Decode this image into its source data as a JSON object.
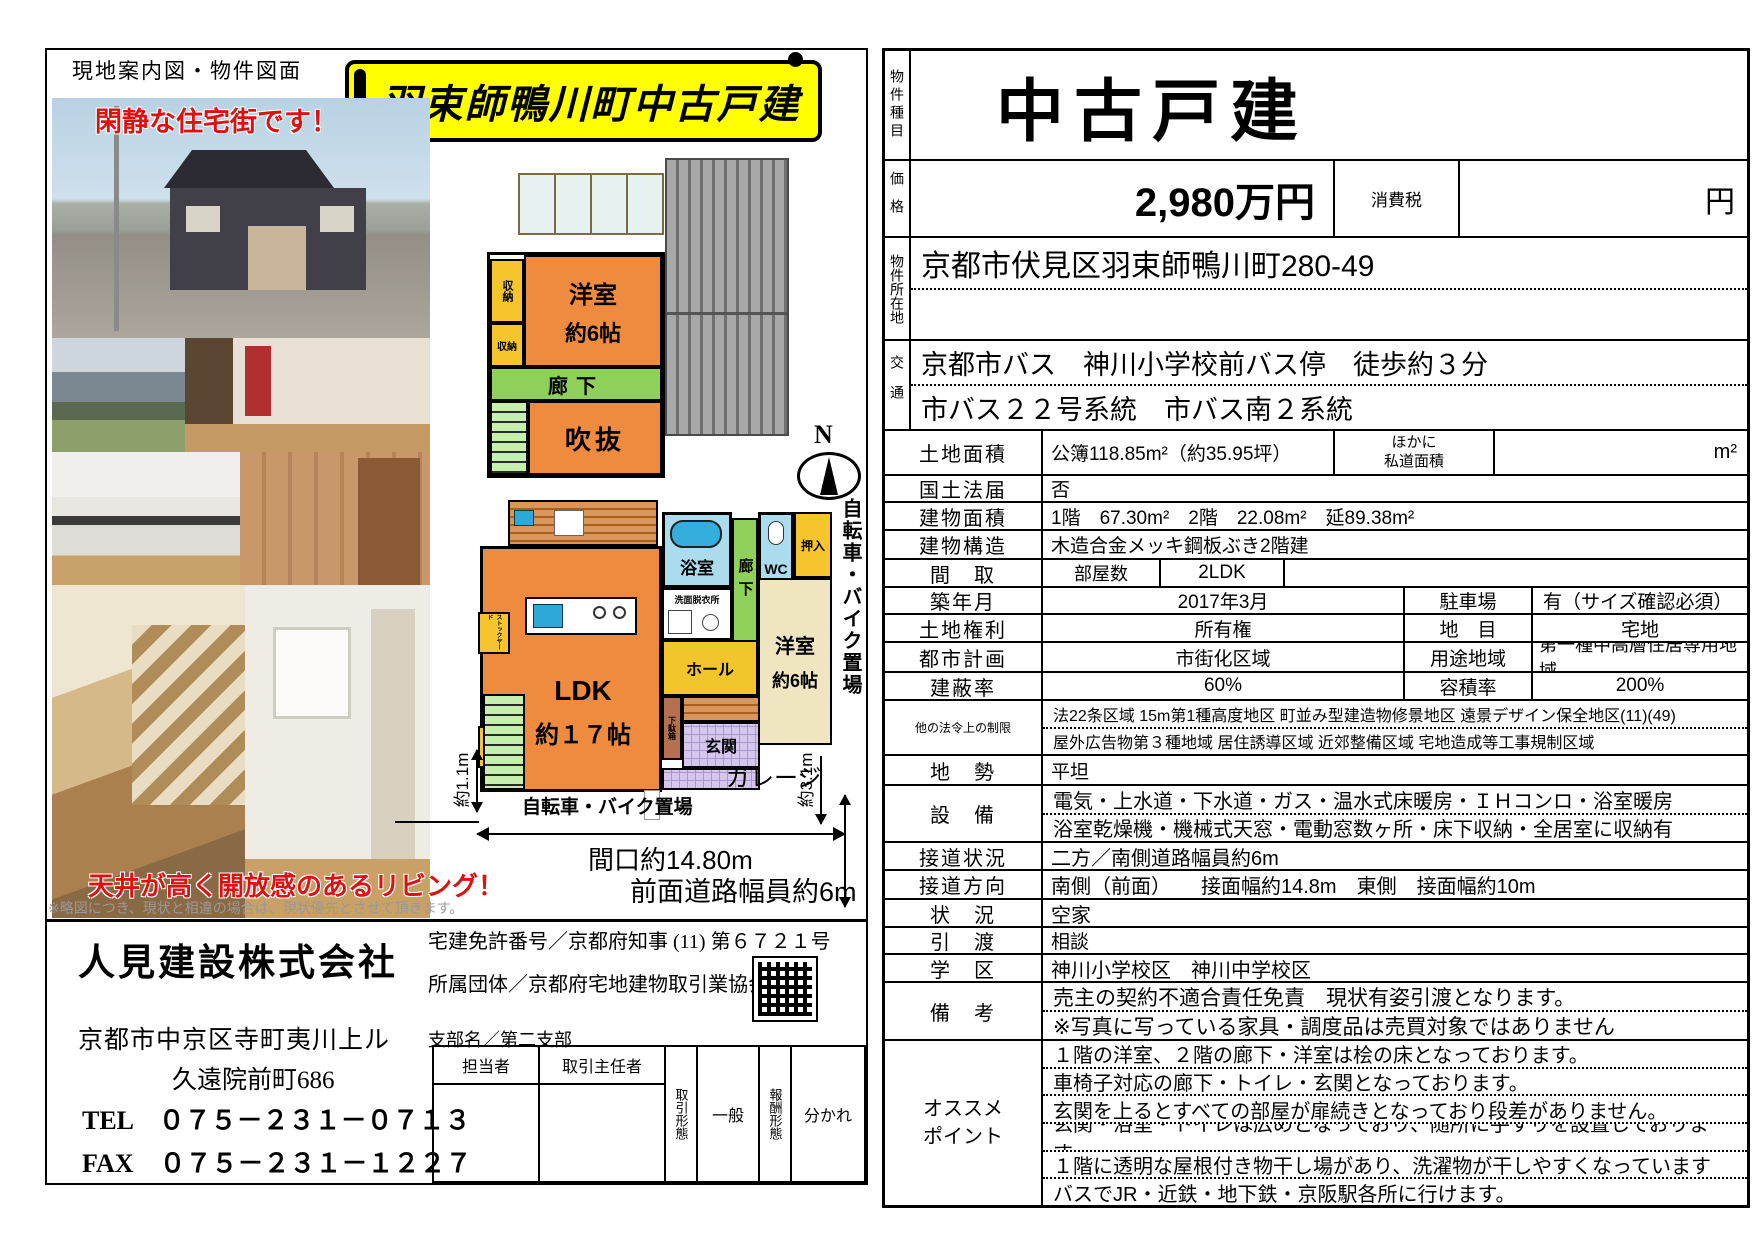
{
  "colors": {
    "banner_bg": "#ffff00",
    "accent_red": "#dd1111",
    "plan_orange": "#ef8b3f",
    "plan_yellow": "#f6c52e",
    "plan_green": "#8ed05a",
    "plan_lightgreen": "#c4efad",
    "plan_blue": "#aadcee",
    "plan_beige": "#efe5c0",
    "plan_purple": "#d5c6ee",
    "roof_gray": "#9a9a9a"
  },
  "left": {
    "header": "現地案内図・物件図面",
    "banner": "羽束師鴨川町中古戸建",
    "caption_quiet": "閑静な住宅街です！",
    "caption_living": "天井が高く開放感のあるリビング！",
    "note": "※略図につき、現状と相違の場合は、現状優先とさせて頂きます。",
    "plan": {
      "f2": {
        "closet1": "収納",
        "closet2": "収納",
        "bedroom": "洋室",
        "bedroom_size": "約6帖",
        "corridor": "廊下",
        "void_space": "吹抜"
      },
      "f1": {
        "bath": "浴室",
        "washroom": "洗面脱衣所",
        "corridor": "廊下",
        "wc": "WC",
        "oshiire": "押入",
        "bedroom": "洋室",
        "bedroom_size": "約6帖",
        "hall": "ホール",
        "entrance": "玄関",
        "shoebox": "下駄箱",
        "ldk": "LDK",
        "ldk_size": "約１７帖",
        "storage": "収納",
        "stockyard": "ストックヤード"
      },
      "annot": {
        "north": "N",
        "bike_side": "自転車・バイク置場",
        "bike_bottom": "自転車・バイク置場",
        "garage": "ガレージ",
        "frontage": "間口約14.80m",
        "front_road": "前面道路幅員約6m",
        "dim31": "約3.1m",
        "dim11": "約1.1m"
      }
    },
    "company": {
      "name": "人見建設株式会社",
      "license": "宅建免許番号／京都府知事 (11) 第６７２１号",
      "org": "所属団体／京都府宅地建物取引業協会",
      "branch": "支部名／第二支部",
      "addr1": "京都市中京区寺町夷川上ル",
      "addr2": "久遠院前町686",
      "tel": "TEL　０７５－２３１－０７１３",
      "fax": "FAX　０７５－２３１－１２２７"
    },
    "agent_table": {
      "staff": "担当者",
      "chief": "取引主任者",
      "deal_type": "取引形態",
      "deal_type_value": "一般",
      "fee_type": "報酬形態",
      "fee_type_value": "分かれ"
    }
  },
  "right": {
    "type_label": "物件種目",
    "type_value": "中古戸建",
    "price_label": "価格",
    "price_value": "2,980万円",
    "tax_label": "消費税",
    "yen": "円",
    "loc_label": "物件所在地",
    "loc_value": "京都市伏見区羽束師鴨川町280-49",
    "transport_label": "交通",
    "transport1": "京都市バス　神川小学校前バス停　徒歩約３分",
    "transport2": "市バス２２号系統　市バス南２系統",
    "land_label": "土地面積",
    "land_value": "公簿118.85m²（約35.95坪）",
    "road_share_label1": "ほかに",
    "road_share_label2": "私道面積",
    "road_share_unit": "m²",
    "kokudo_label": "国土法届",
    "kokudo_value": "否",
    "bldg_area_label": "建物面積",
    "bldg_area_value": "1階　67.30m²　2階　22.08m²　延89.38m²",
    "structure_label": "建物構造",
    "structure_value": "木造合金メッキ鋼板ぶき2階建",
    "madori_label": "間　取",
    "rooms_label": "部屋数",
    "rooms_value": "2LDK",
    "built_label": "築年月",
    "built_value": "2017年3月",
    "parking_label": "駐車場",
    "parking_value": "有（サイズ確認必須）",
    "rights_label": "土地権利",
    "rights_value": "所有権",
    "chimoku_label": "地　目",
    "chimoku_value": "宅地",
    "cityplan_label": "都市計画",
    "cityplan_value": "市街化区域",
    "yoto_label": "用途地域",
    "yoto_value": "第一種中高層住居専用地域",
    "kenpei_label": "建蔽率",
    "kenpei_value": "60%",
    "yoseki_label": "容積率",
    "yoseki_value": "200%",
    "law_label": "他の法令上の制限",
    "law1": "法22条区域 15m第1種高度地区 町並み型建造物修景地区 遠景デザイン保全地区(11)(49)",
    "law2": "屋外広告物第３種地域 居住誘導区域 近郊整備区域 宅地造成等工事規制区域",
    "chisei_label": "地　勢",
    "chisei_value": "平坦",
    "setsubi_label": "設　備",
    "setsubi1": "電気・上水道・下水道・ガス・温水式床暖房・ＩＨコンロ・浴室暖房",
    "setsubi2": "浴室乾燥機・機械式天窓・電動窓数ヶ所・床下収納・全居室に収納有",
    "road_label": "接道状況",
    "road_value": "二方／南側道路幅員約6m",
    "roaddir_label": "接道方向",
    "roaddir_value": "南側（前面）　　接面幅約14.8m　東側　接面幅約10m",
    "jokyo_label": "状　況",
    "jokyo_value": "空家",
    "hikiwatashi_label": "引　渡",
    "hikiwatashi_value": "相談",
    "gakku_label": "学　区",
    "gakku_value": "神川小学校区　神川中学校区",
    "biko_label": "備　考",
    "biko1": "売主の契約不適合責任免責　現状有姿引渡となります。",
    "biko2": "※写真に写っている家具・調度品は売買対象ではありません",
    "osusume1": "オススメ",
    "osusume2": "ポイント",
    "points": [
      "１階の洋室、２階の廊下・洋室は桧の床となっております。",
      "車椅子対応の廊下・トイレ・玄関となっております。",
      "玄関を上るとすべての部屋が扉続きとなっており段差がありません。",
      "玄関・浴室・トイレは広めとなっており、随所に手すりを設置しております。",
      "１階に透明な屋根付き物干し場があり、洗濯物が干しやすくなっています",
      "バスでJR・近鉄・地下鉄・京阪駅各所に行けます。"
    ]
  }
}
